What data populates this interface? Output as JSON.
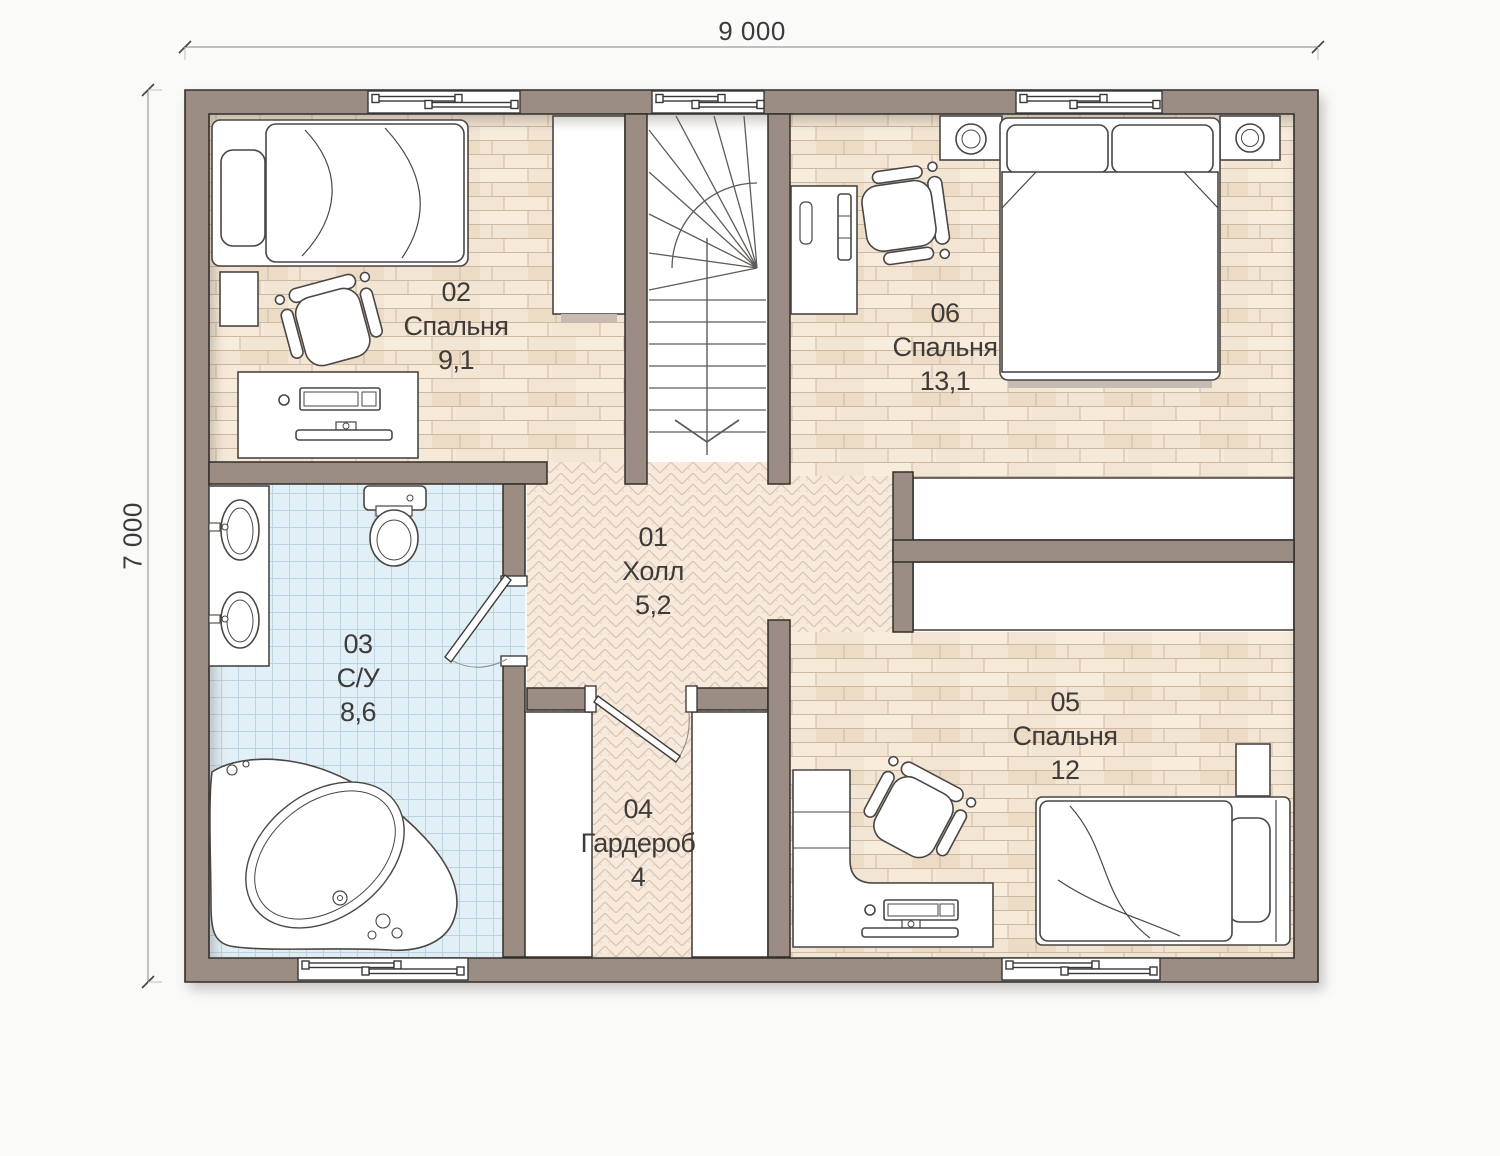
{
  "plan": {
    "type": "second-floor plan",
    "dimensions": {
      "width_label": "9 000",
      "height_label": "7 000"
    },
    "rooms": [
      {
        "number": "01",
        "name": "Холл",
        "area": "5,2",
        "floor": "herringbone-parquet",
        "furniture": [
          "staircase"
        ]
      },
      {
        "number": "02",
        "name": "Спальня",
        "area": "9,1",
        "floor": "wood-plank",
        "furniture": [
          "single-bed",
          "pillow",
          "nightstand",
          "office-chair",
          "desk",
          "keyboard",
          "monitor",
          "mouse",
          "wardrobe",
          "window"
        ]
      },
      {
        "number": "03",
        "name": "С/У",
        "area": "8,6",
        "floor": "blue-tile",
        "furniture": [
          "double-vanity",
          "sink",
          "sink",
          "toilet",
          "corner-bathtub",
          "door",
          "window"
        ]
      },
      {
        "number": "04",
        "name": "Гардероб",
        "area": "4",
        "floor": "herringbone-parquet",
        "furniture": [
          "closet",
          "closet",
          "door"
        ]
      },
      {
        "number": "05",
        "name": "Спальня",
        "area": "12",
        "floor": "wood-plank",
        "furniture": [
          "single-bed",
          "pillow",
          "nightstand",
          "l-desk",
          "office-chair",
          "keyboard",
          "monitor",
          "mouse",
          "closet",
          "window"
        ]
      },
      {
        "number": "06",
        "name": "Спальня",
        "area": "13,1",
        "floor": "wood-plank",
        "furniture": [
          "double-bed",
          "pillow",
          "pillow",
          "nightstand",
          "nightstand",
          "lamp",
          "lamp",
          "desk",
          "office-chair",
          "closet",
          "window"
        ]
      }
    ],
    "colors": {
      "wall": "#9c8d84",
      "wall_outline": "#322e2b",
      "wood_floor": "#f3e5d4",
      "herringbone_floor": "#f7e9dc",
      "tile_floor": "#e1eff6",
      "fixture_fill": "#ffffff",
      "fixture_stroke": "#4a4644",
      "background": "#fafaf9",
      "label_text": "#3f3b38"
    }
  }
}
